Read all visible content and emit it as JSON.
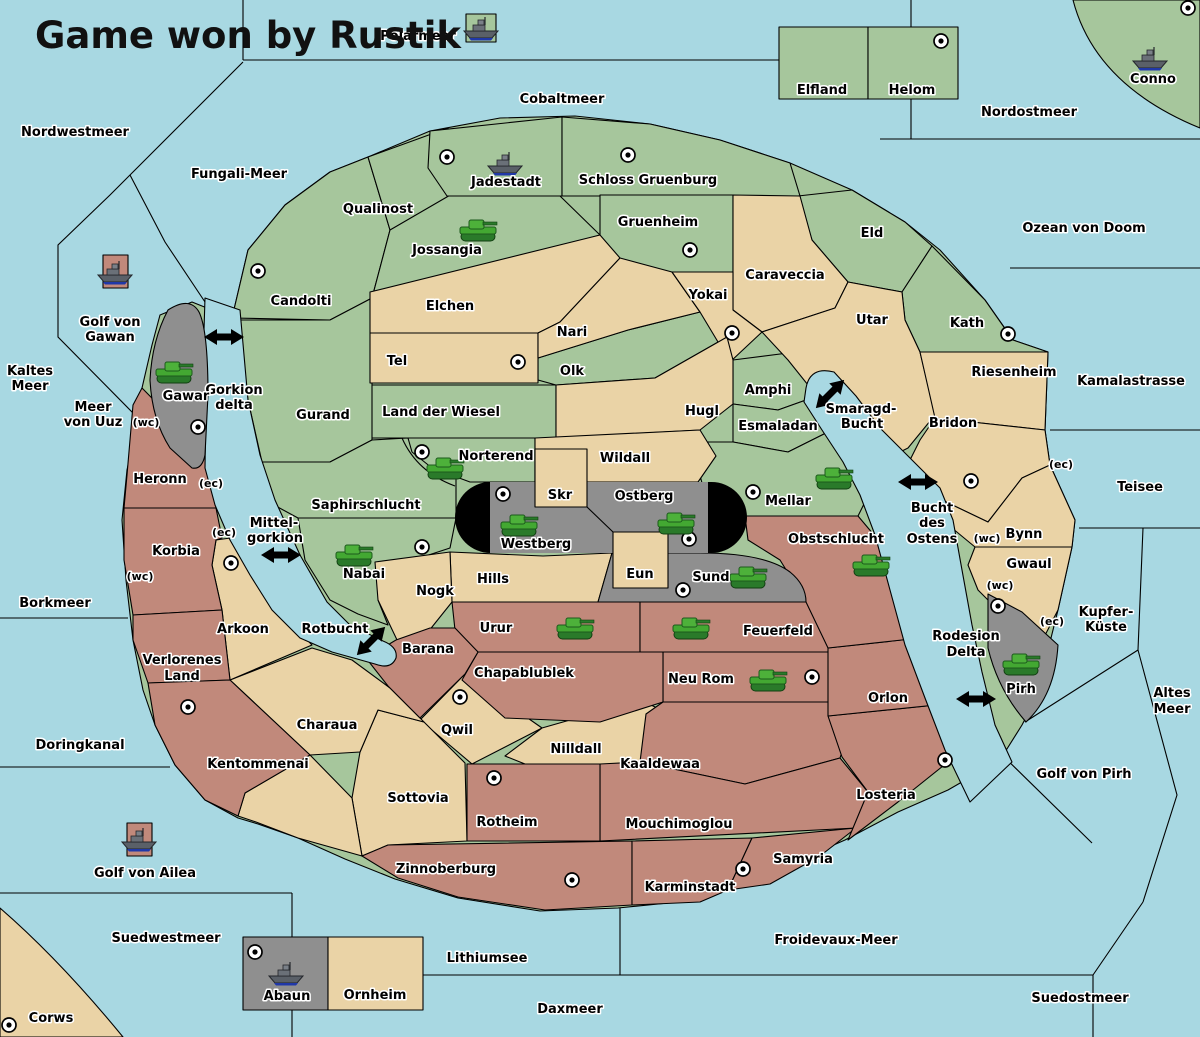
{
  "title": "Game won by Rustik",
  "colors": {
    "sea": "#a8d8e2",
    "land_green": "#a6c69c",
    "land_tan": "#ead3a6",
    "land_red": "#c1897b",
    "land_gray": "#8f8f8f",
    "border": "#000000",
    "unit_tank": "#43a832",
    "unit_ship": "#5a6068",
    "impassable": "#000000"
  },
  "t": {
    "title": "Game won by Rustik",
    "polarmeer": "Polarmeer",
    "nordwestmeer": "Nordwestmeer",
    "fungali": "Fungali-Meer",
    "cobaltmeer": "Cobaltmeer",
    "nordostmeer": "Nordostmeer",
    "ozean": "Ozean von Doom",
    "kamalastrasse": "Kamalastrasse",
    "teisee": "Teisee",
    "kupfer1": "Kupfer-",
    "kupfer2": "Küste",
    "altes1": "Altes",
    "altes2": "Meer",
    "golfpirh": "Golf von Pirh",
    "froidevaux": "Froidevaux-Meer",
    "suedostmeer": "Suedostmeer",
    "daxmeer": "Daxmeer",
    "lithiumsee": "Lithiumsee",
    "suedwestmeer": "Suedwestmeer",
    "borkmeer": "Borkmeer",
    "doringkanal": "Doringkanal",
    "kaltes1": "Kaltes",
    "kaltes2": "Meer",
    "uuz1": "Meer",
    "uuz2": "von Uuz",
    "gvgawan1": "Golf von",
    "gvgawan2": "Gawan",
    "gvailea": "Golf von Ailea",
    "gorkion1": "Gorkion",
    "gorkion2": "delta",
    "mittel1": "Mittel-",
    "mittel2": "gorkion",
    "rotbucht": "Rotbucht",
    "smaragd1": "Smaragd-",
    "smaragd2": "Bucht",
    "bucht1": "Bucht",
    "bucht2": "des",
    "bucht3": "Ostens",
    "rodesion1": "Rodesion",
    "rodesion2": "Delta",
    "candolti": "Candolti",
    "qualinost": "Qualinost",
    "jossangia": "Jossangia",
    "jadestadt": "Jadestadt",
    "schloss": "Schloss Gruenburg",
    "gruenheim": "Gruenheim",
    "caraveccia": "Caraveccia",
    "eld": "Eld",
    "yokai": "Yokai",
    "utar": "Utar",
    "kath": "Kath",
    "riesenheim": "Riesenheim",
    "bridon": "Bridon",
    "amphi": "Amphi",
    "esmaladan": "Esmaladan",
    "hugl": "Hugl",
    "nari": "Nari",
    "olk": "Olk",
    "elchen": "Elchen",
    "tel": "Tel",
    "gurand": "Gurand",
    "ldw": "Land der Wiesel",
    "norterend": "Norterend",
    "wildall": "Wildall",
    "skr": "Skr",
    "ostberg": "Ostberg",
    "westberg": "Westberg",
    "eun": "Eun",
    "sund": "Sund",
    "mellar": "Mellar",
    "saphirschlucht": "Saphirschlucht",
    "nabai": "Nabai",
    "hills": "Hills",
    "nogk": "Nogk",
    "urur": "Urur",
    "feuerfeld": "Feuerfeld",
    "obstschlucht": "Obstschlucht",
    "neurom": "Neu Rom",
    "chapablublek": "Chapablublek",
    "qwil": "Qwil",
    "nilldall": "Nilldall",
    "kaaldewaa": "Kaaldewaa",
    "mouchimoglou": "Mouchimoglou",
    "rotheim": "Rotheim",
    "sottovia": "Sottovia",
    "barana": "Barana",
    "arkoon": "Arkoon",
    "charaua": "Charaua",
    "kentommenai": "Kentommenai",
    "verl1": "Verlorenes",
    "verl2": "Land",
    "korbia": "Korbia",
    "heronn": "Heronn",
    "gawar": "Gawar",
    "zinnoberburg": "Zinnoberburg",
    "karminstadt": "Karminstadt",
    "samyria": "Samyria",
    "losteria": "Losteria",
    "orlon": "Orlon",
    "bynn": "Bynn",
    "gwaul": "Gwaul",
    "pirh": "Pirh",
    "elfland": "Elfland",
    "helom": "Helom",
    "conno": "Conno",
    "abaun": "Abaun",
    "ornheim": "Ornheim",
    "corws": "Corws",
    "wc": "(wc)",
    "ec": "(ec)"
  },
  "supply_centers": [
    "Jadestadt",
    "Schloss Gruenburg",
    "Helom",
    "Conno",
    "Gruenheim",
    "Candolti",
    "Yokai",
    "Tel",
    "Kath",
    "Bridon",
    "Gawar",
    "Norterend",
    "Westberg",
    "Ostberg",
    "Sund",
    "Mellar",
    "Nabai",
    "Arkoon",
    "Kentommenai",
    "Qwil",
    "Rotheim",
    "Zinnoberburg",
    "Samyria",
    "Losteria",
    "Neu Rom",
    "Pirh",
    "Abaun",
    "Corws"
  ],
  "units": {
    "armies_tanks": [
      "Jossangia",
      "Norterend",
      "Nabai",
      "Westberg",
      "Ostberg",
      "Sund",
      "Mellar",
      "Obstschlucht",
      "Urur",
      "Feuerfeld",
      "Neu Rom",
      "Gawar",
      "Pirh"
    ],
    "fleets_ships": [
      "Jadestadt",
      "Conno",
      "Golf von Gawan",
      "Golf von Ailea",
      "Abaun"
    ],
    "title_badge": "fleet on green (winner Rustik)"
  },
  "coast_annotations": [
    "Heronn (wc)",
    "Heronn (ec)",
    "Korbia (ec)",
    "Korbia (wc)",
    "Bridon (ec)",
    "Bynn (wc)",
    "Gwaul (wc)",
    "Gwaul (ec)"
  ]
}
